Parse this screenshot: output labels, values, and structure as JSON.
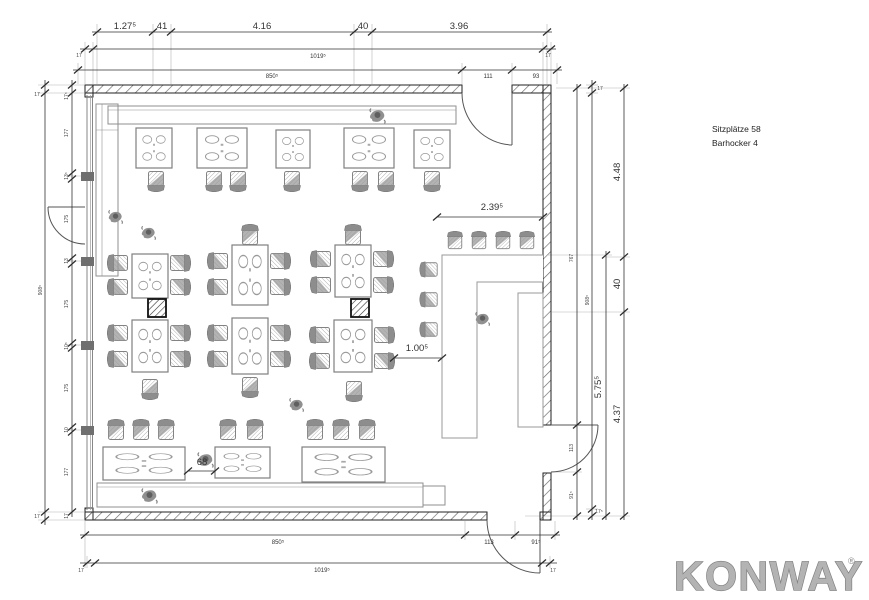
{
  "annotations": {
    "seats": "Sitzplätze 58",
    "barstools": "Barhocker 4"
  },
  "logo": {
    "text": "KONWAY",
    "reg": "®"
  },
  "dims": {
    "top1": {
      "d1": "1.27⁵",
      "d2": "41",
      "d3": "4.16",
      "d4": "40",
      "d5": "3.96"
    },
    "top2": {
      "left": "17",
      "total": "1019⁵",
      "right": "17"
    },
    "top3": {
      "total": "850⁵",
      "door": "111",
      "corner": "93"
    },
    "bottom1": {
      "total": "850⁵",
      "door": "113",
      "corner": "91⁵"
    },
    "bottom2": {
      "left": "17",
      "total": "1019⁵",
      "right": "17"
    },
    "left_outer": {
      "top": "17",
      "total": "908⁵",
      "bottom": "17"
    },
    "left_inner": {
      "top": "17⁵",
      "s1": "177",
      "s2": "13⁵",
      "s3": "175",
      "s4": "13",
      "s5": "175",
      "s6": "10⁵",
      "s7": "175",
      "s8": "10",
      "s9": "177",
      "bottom": "17"
    },
    "right_a": {
      "upper": "767",
      "door": "113",
      "lower": "91⁵"
    },
    "right_b": {
      "top": "17",
      "total": "908⁵",
      "bottom": "17⁵"
    },
    "right_c": {
      "seg": "5.75⁵"
    },
    "right_d": {
      "s1": "4.48",
      "s2": "40",
      "s3": "4.37"
    },
    "interior": {
      "bar_front": "2.39⁵",
      "bar_aisle": "1.00⁵",
      "table_gap": "68"
    }
  },
  "colors": {
    "wall_hatch": "#666666",
    "dimension_line": "#333333",
    "furniture_line": "#999999",
    "logo_gray": "#b3b3b3"
  }
}
